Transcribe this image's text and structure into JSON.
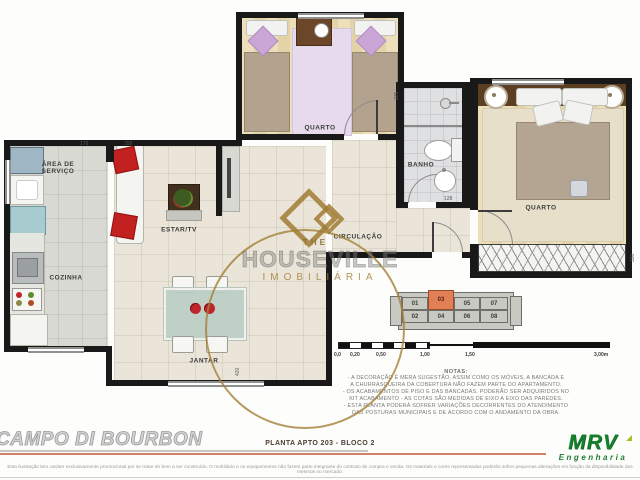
{
  "plan": {
    "labels": {
      "area_servico": "ÁREA DE\nSERVIÇO",
      "cozinha": "COZINHA",
      "estar": "ESTAR/TV",
      "jantar": "JANTAR",
      "quarto1": "QUARTO",
      "quarto2": "QUARTO",
      "banho": "BANHO",
      "circulacao": "CIRCULAÇÃO"
    },
    "dims": [
      "178",
      "258",
      "225",
      "420",
      "330",
      "128"
    ]
  },
  "watermark": {
    "brand_top": "THE",
    "brand": "HOUSEVILLE",
    "brand_sub": "IMOBILIÁRIA"
  },
  "keyplan": {
    "top": [
      "01",
      "03",
      "05",
      "07"
    ],
    "bottom": [
      "02",
      "04",
      "06",
      "08"
    ],
    "highlighted_unit": "03"
  },
  "scalebar": {
    "labels": [
      "0,0",
      "0,20",
      "0,50",
      "1,00",
      "1,50",
      "3,00m"
    ]
  },
  "notes": {
    "title": "NOTAS:",
    "lines": [
      "- A DECORAÇÃO É MERA SUGESTÃO, ASSIM COMO OS MÓVEIS, A BANCADA E",
      "A CHURRASQUEIRA DA COBERTURA NÃO FAZEM PARTE DO APARTAMENTO.",
      "- OS ACABAMENTOS DE PISO E DAS BANCADAS, PODERÃO SER ADQUIRIDOS NO",
      "KIT ACABAMENTO - AS COTAS SÃO MEDIDAS DE EIXO A EIXO DAS PAREDES.",
      "- ESTA PLANTA PODERÁ SOFRER VARIAÇÕES DECORRENTES DO ATENDIMENTO",
      "DAS POSTURAS MUNICIPAIS E DE ACORDO COM O ANDAMENTO DA OBRA."
    ]
  },
  "footer": {
    "project": "CAMPO DI BOURBON",
    "plan_ref": "PLANTA APTO 203 - BLOCO 2",
    "logo": "MRV",
    "logo_sub": "Engenharia",
    "disclaimer": "Esta ilustração tem caráter exclusivamente promocional por se tratar de bem a ser construído. O mobiliário e os equipamentos não fazem parte integrante do contrato de compra e venda. Os materiais e cores representados poderão sofrer pequenas alterações em função da disponibilidade dos mesmos no mercado."
  },
  "colors": {
    "highlight_unit": "#e18057",
    "watermark_gold": "#a4813a",
    "mrv_green": "#17802c",
    "wall": "#191919",
    "salmon_rule": "#d08268"
  }
}
